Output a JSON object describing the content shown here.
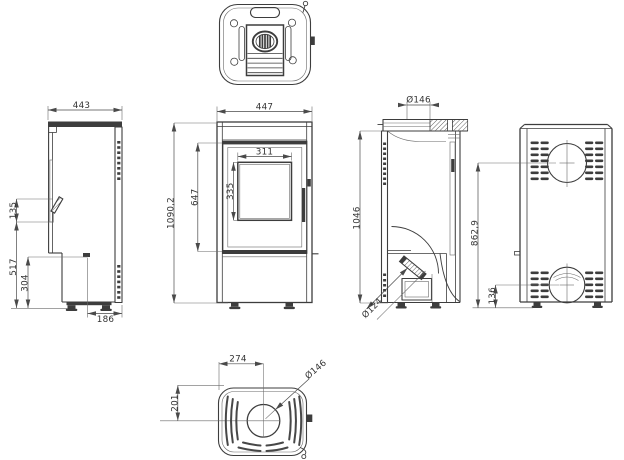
{
  "drawing": {
    "background_color": "#ffffff",
    "line_color": "#3d3d3d",
    "dim_line_color": "#4a4a4a",
    "text_color": "#333333",
    "dims": {
      "left_width": "443",
      "left_handle_height": "135",
      "left_lower_height": "517",
      "left_base_height": "304",
      "left_rear_depth": "186",
      "front_width": "447",
      "front_glass_width": "311",
      "front_glass_height": "335",
      "front_door_height": "647",
      "front_total_height": "1090,2",
      "side_flue_diameter": "Ø146",
      "side_height": "1046",
      "side_ash_diameter": "Ø124",
      "back_flue_center_height": "862,9",
      "back_intake_center_height": "136",
      "bottom_center_offset_x": "274",
      "bottom_center_offset_y": "201",
      "bottom_flue_diameter": "Ø146"
    }
  }
}
